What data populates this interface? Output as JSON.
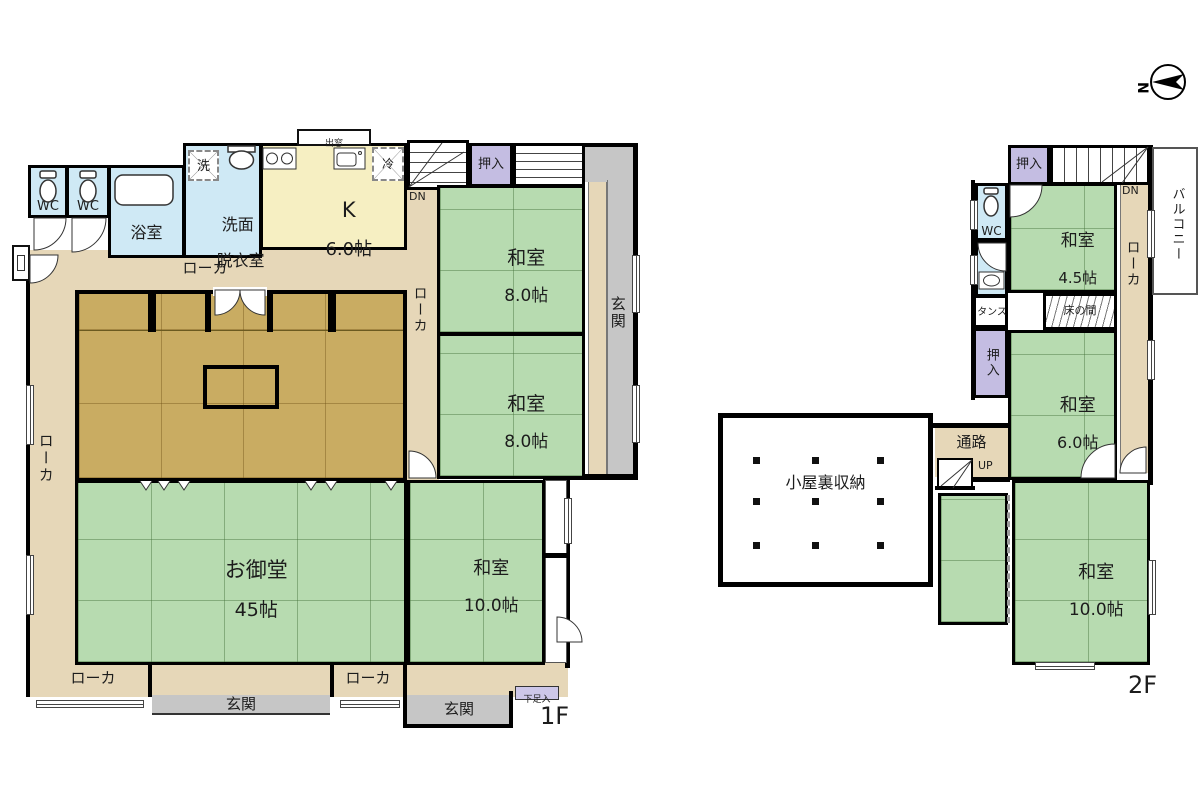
{
  "compass": {
    "north": "N"
  },
  "colors": {
    "tatami": "#b7dbb0",
    "wood_floor": "#c9ac62",
    "corridor": "#e6d7b8",
    "kitchen": "#f6efc2",
    "water_rooms": "#cfe9f5",
    "closet": "#c4bde2",
    "genkan": "#c6c6c6",
    "wall": "#000000"
  },
  "floor1": {
    "label": "1F",
    "wc1": "WC",
    "wc2": "WC",
    "bath": "浴室",
    "washroom_line1": "洗面",
    "washroom_line2": "脱衣室",
    "washer": "洗",
    "bay_window": "出窓",
    "kitchen_name": "K",
    "kitchen_size": "6.0帖",
    "fridge": "冷",
    "stairs_dn": "DN",
    "closet": "押入",
    "washitsu_ne_name": "和室",
    "washitsu_ne_size": "8.0帖",
    "washitsu_e_name": "和室",
    "washitsu_e_size": "8.0帖",
    "genkan_east": "玄関",
    "corridor_top": "ローカ",
    "corridor_west": "ローカ",
    "corridor_center": "ローカ",
    "hall_name": "お御堂",
    "hall_size": "45帖",
    "washitsu_se_name": "和室",
    "washitsu_se_size": "10.0帖",
    "corridor_south_left": "ローカ",
    "corridor_south_right": "ローカ",
    "genkan_south": "玄関",
    "genkan_southeast": "玄関",
    "shoe_cabinet": "下足入"
  },
  "floor2": {
    "label": "2F",
    "closet_north": "押入",
    "stairs_dn": "DN",
    "balcony": "バルコニー",
    "wc": "WC",
    "washitsu_n_name": "和室",
    "washitsu_n_size": "4.5帖",
    "corridor_east": "ローカ",
    "tansu": "タンス",
    "tokonoma": "床の間",
    "closet_mid": "押入",
    "washitsu_c_name": "和室",
    "washitsu_c_size": "6.0帖",
    "attic": "小屋裏収納",
    "passage": "通路",
    "stairs_up": "UP",
    "washitsu_s_name": "和室",
    "washitsu_s_size": "10.0帖"
  }
}
